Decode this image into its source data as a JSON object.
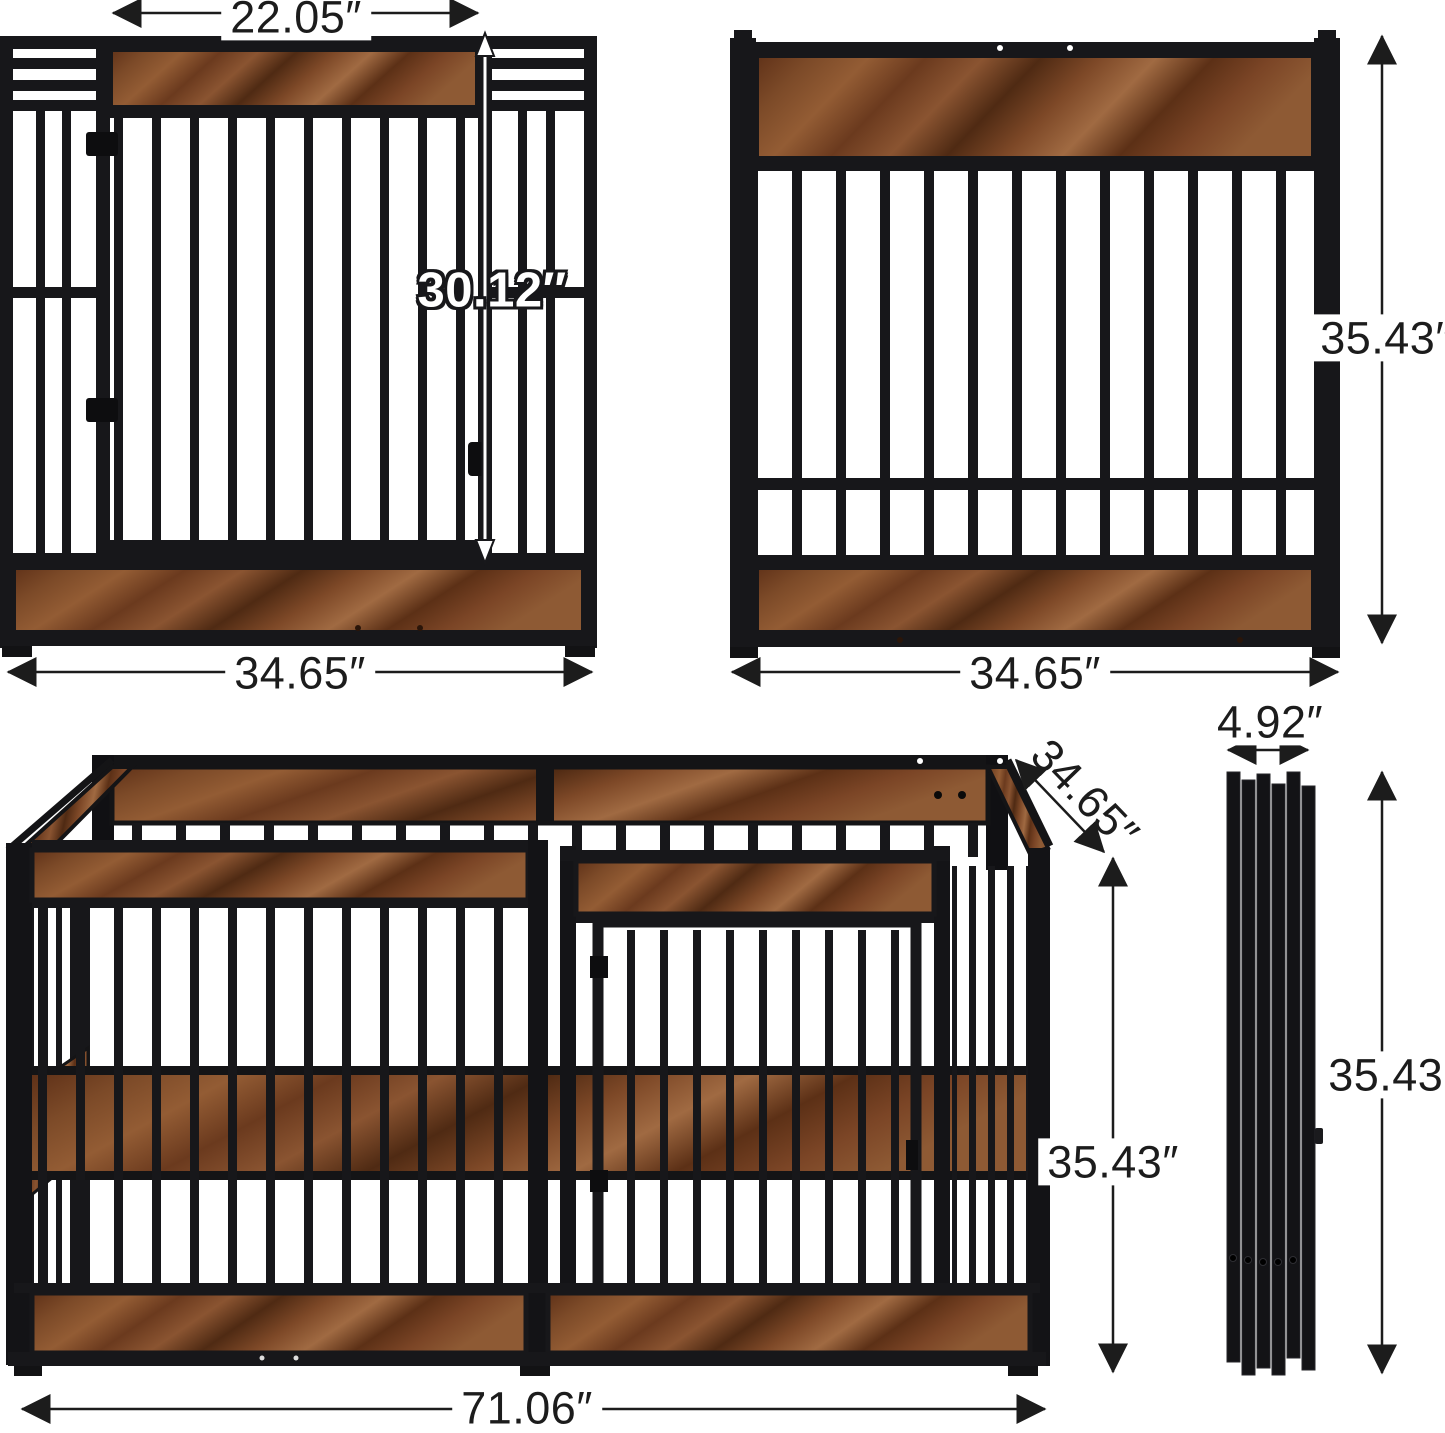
{
  "dimensions": {
    "door_width": "22.05″",
    "door_height": "30.12″",
    "front_panel_width": "34.65″",
    "side_panel_width": "34.65″",
    "side_panel_height": "35.43″",
    "pen_depth": "34.65″",
    "folded_depth": "4.92″",
    "pen_height": "35.43″",
    "folded_height": "35.43″",
    "pen_width": "71.06″"
  },
  "colors": {
    "background": "#ffffff",
    "metal_frame": "#17171a",
    "wood_light": "#9a6238",
    "wood_mid": "#7c4a28",
    "wood_dark": "#4f2a13",
    "dimension_text": "#1c1c1c",
    "door_height_text": "#ffffff"
  }
}
